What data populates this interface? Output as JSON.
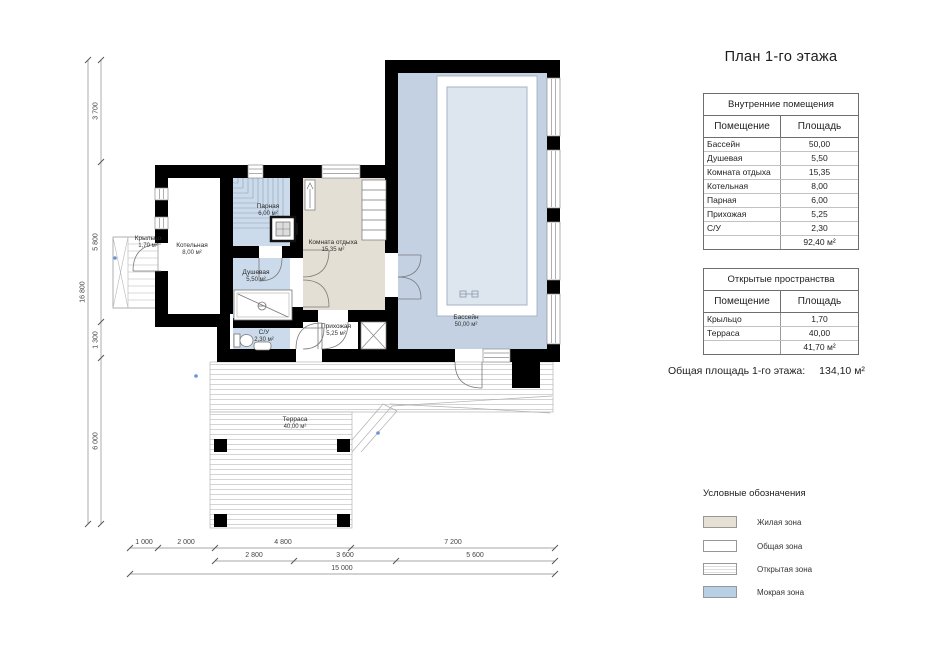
{
  "title": "План 1-го этажа",
  "colors": {
    "wall": "#000000",
    "wet_zone": "#ccdbeb",
    "living_zone": "#e4dfd4",
    "pool_floor": "#c3d1e2",
    "pool_basin": "#dde5ef"
  },
  "tables": {
    "internal": {
      "title": "Внутренние помещения",
      "columns": {
        "room": "Помещение",
        "area": "Площадь"
      },
      "rows": [
        {
          "room": "Бассейн",
          "area": "50,00"
        },
        {
          "room": "Душевая",
          "area": "5,50"
        },
        {
          "room": "Комната отдыха",
          "area": "15,35"
        },
        {
          "room": "Котельная",
          "area": "8,00"
        },
        {
          "room": "Парная",
          "area": "6,00"
        },
        {
          "room": "Прихожая",
          "area": "5,25"
        },
        {
          "room": "С/У",
          "area": "2,30"
        }
      ],
      "total": "92,40 м²"
    },
    "open": {
      "title": "Открытые пространства",
      "columns": {
        "room": "Помещение",
        "area": "Площадь"
      },
      "rows": [
        {
          "room": "Крыльцо",
          "area": "1,70"
        },
        {
          "room": "Терраса",
          "area": "40,00"
        }
      ],
      "total": "41,70 м²"
    }
  },
  "summary": {
    "label": "Общая площадь 1-го этажа:",
    "value": "134,10 м²"
  },
  "legend": {
    "title": "Условные обозначения",
    "items": [
      {
        "label": "Жилая зона",
        "color": "#e6e0d4",
        "pattern": "solid"
      },
      {
        "label": "Общая зона",
        "color": "#ffffff",
        "pattern": "solid"
      },
      {
        "label": "Открытая зона",
        "color": "#ffffff",
        "pattern": "h-lines"
      },
      {
        "label": "Мокрая зона",
        "color": "#b9cfe6",
        "pattern": "solid"
      }
    ]
  },
  "plan": {
    "rooms": [
      {
        "name": "Бассейн",
        "area": "50,00 м²"
      },
      {
        "name": "Комната отдыха",
        "area": "15,35 м²"
      },
      {
        "name": "Парная",
        "area": "6,00 м²"
      },
      {
        "name": "Душевая",
        "area": "5,50 м²"
      },
      {
        "name": "С/У",
        "area": "2,30 м²"
      },
      {
        "name": "Котельная",
        "area": "8,00 м²"
      },
      {
        "name": "Прихожая",
        "area": "5,25 м²"
      },
      {
        "name": "Крыльцо",
        "area": "1,70 м²"
      },
      {
        "name": "Терраса",
        "area": "40,00 м²"
      }
    ],
    "dimensions": {
      "left_total": "16 800",
      "left_segments": [
        "3 700",
        "5 800",
        "1 300",
        "6 000"
      ],
      "bottom_row1": [
        "1 000",
        "2 000",
        "4 800",
        "7 200"
      ],
      "bottom_row2": [
        "2 800",
        "3 600",
        "5 600"
      ],
      "bottom_total": "15 000"
    }
  }
}
